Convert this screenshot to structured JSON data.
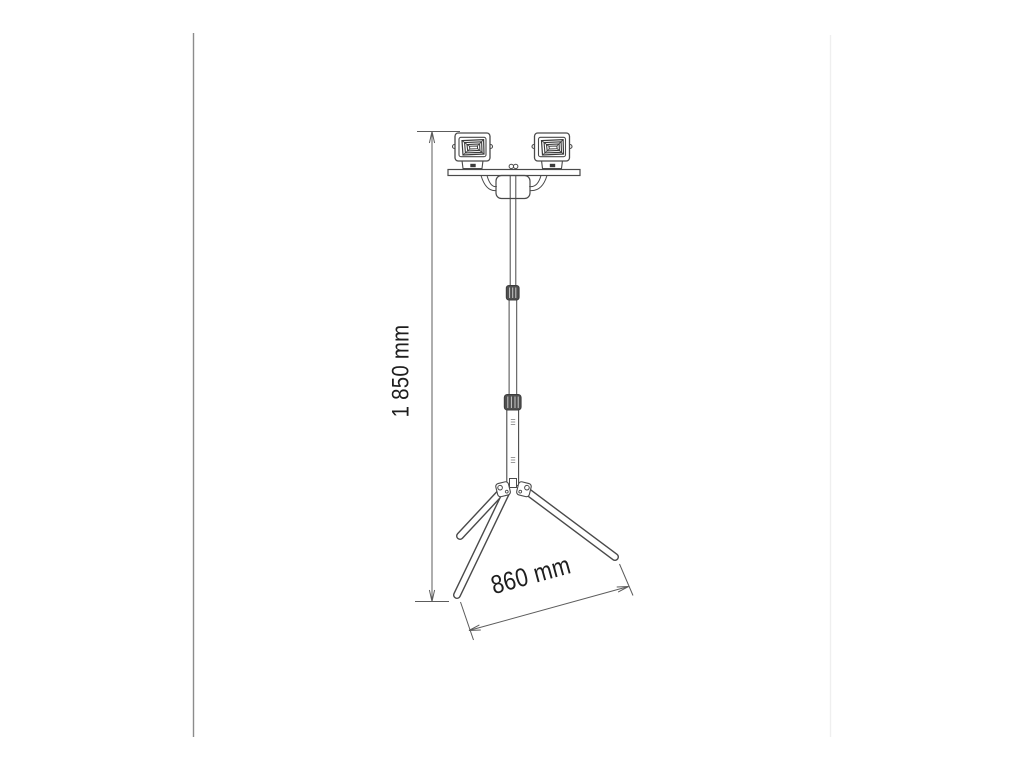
{
  "meta": {
    "type": "technical-dimension-diagram",
    "subject": "Dual-head LED work light on telescopic tripod stand"
  },
  "labels": {
    "height": "1 850 mm",
    "base_width": "860 mm"
  },
  "parts": [
    "floodlight-head-left",
    "floodlight-head-right",
    "mounting-crossbar",
    "center-bracket",
    "telescopic-pole",
    "pole-clamp-upper",
    "pole-clamp-lower",
    "tripod-hub",
    "tripod-leg-back-left",
    "tripod-leg-front",
    "tripod-leg-right"
  ],
  "colors": {
    "background": "#ffffff",
    "line": "#4a4a4a",
    "dimension_line": "#5c5c5c",
    "label_text": "#1e1e1e",
    "clamp_fill": "#4f4f4f",
    "left_frame_line": "#8c8c8c",
    "right_frame_line": "#efefef"
  }
}
